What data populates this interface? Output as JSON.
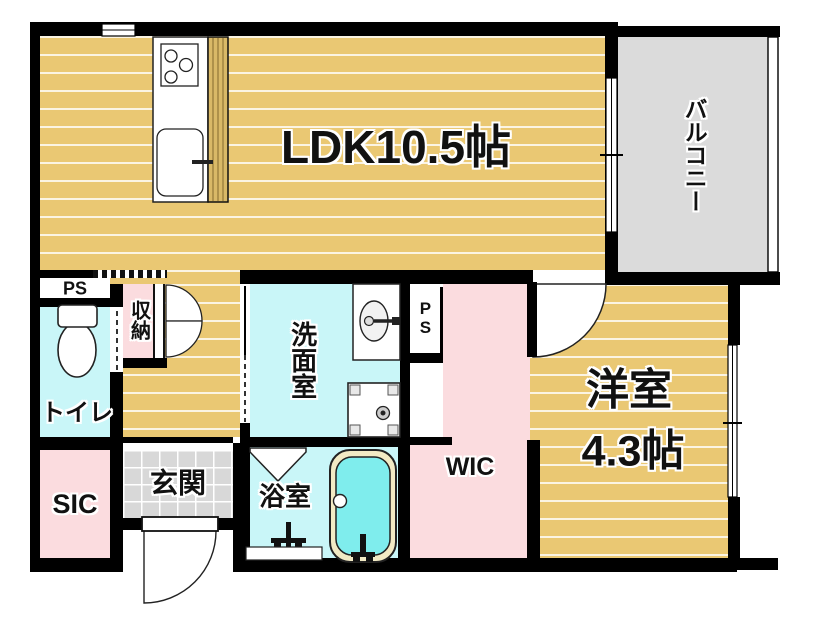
{
  "floorplan": {
    "rooms": {
      "ldk": {
        "label": "LDK10.5帖"
      },
      "balcony": {
        "label": "バルコニー"
      },
      "western_room": {
        "line1": "洋室",
        "line2": "4.3帖"
      },
      "wic": {
        "label": "WIC"
      },
      "washroom": {
        "label": "洗面室"
      },
      "bathroom": {
        "label": "浴室"
      },
      "toilet": {
        "label": "トイレ"
      },
      "storage": {
        "label": "収納"
      },
      "entrance": {
        "label": "玄関"
      },
      "sic": {
        "label": "SIC"
      },
      "pipe_space_left": {
        "label": "PS"
      },
      "pipe_space_center": {
        "label": "PS"
      }
    },
    "colors": {
      "wall": "#000000",
      "wood_floor": "#EAC873",
      "wood_counter": "#D9B967",
      "wet_room_cyan": "#C9F6F8",
      "closet_pink": "#FBDCDF",
      "balcony_gray": "#DBDBDB",
      "tile_gray": "#D8D8D8",
      "bathtub_water": "#7FEDED",
      "bathtub_rim": "#F2EAC4"
    }
  }
}
